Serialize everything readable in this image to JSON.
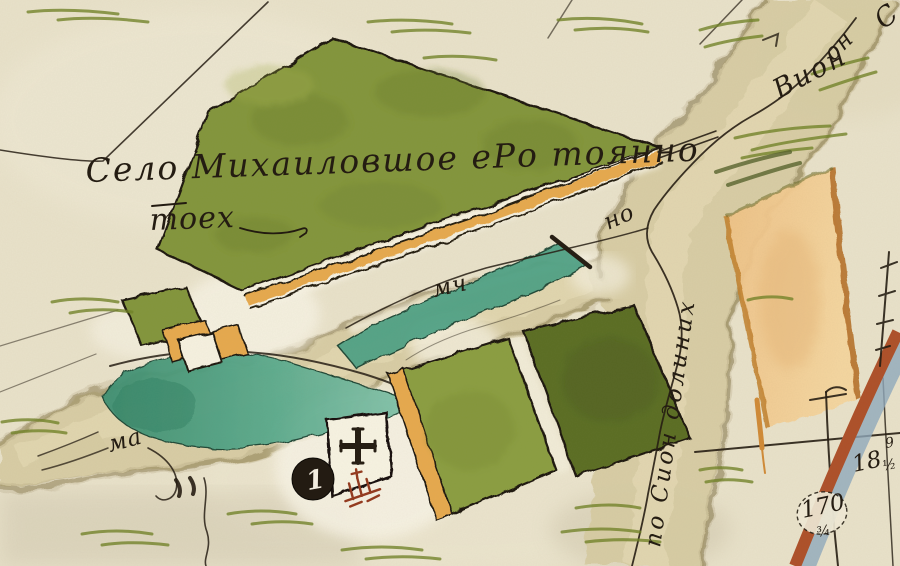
{
  "map": {
    "village_title": {
      "line1": "Село Михаиловшое еРо тоянно",
      "line2": "тоех"
    },
    "labels": {
      "river_name_top": "Вион",
      "river_name_corner": "он",
      "corner_letter": "С",
      "river_no": "но",
      "mill_center": "мч",
      "mill_left": "ма",
      "river_course_vertical": "по Сион долиних"
    },
    "measurements": {
      "plot18": "18",
      "plot18_fraction": "½",
      "plot170": "170",
      "plot170_fraction": "¾",
      "edge_digit": "9"
    },
    "marker1": {
      "label": "1"
    },
    "colors": {
      "paper": "#e9e2ca",
      "paper_light": "#f6f1e0",
      "village_green": "#82953a",
      "field_light_green": "#8a9d40",
      "field_dark_green": "#5a6d22",
      "pond_teal": "#4fa184",
      "pond_teal_dark": "#35836a",
      "road_orange": "#e6a94e",
      "field_orange": "#f2cb90",
      "river_tan": "#d6cba2",
      "river_edge": "#93865c",
      "road_red": "#ad4f28",
      "road_shadow_blue": "#8ea9bd",
      "ink": "#241c12",
      "hatch_green": "#6e8024",
      "chapel_red": "#93381c",
      "marker_bg": "#231b12",
      "marker_fg": "#f2ecdf"
    }
  }
}
